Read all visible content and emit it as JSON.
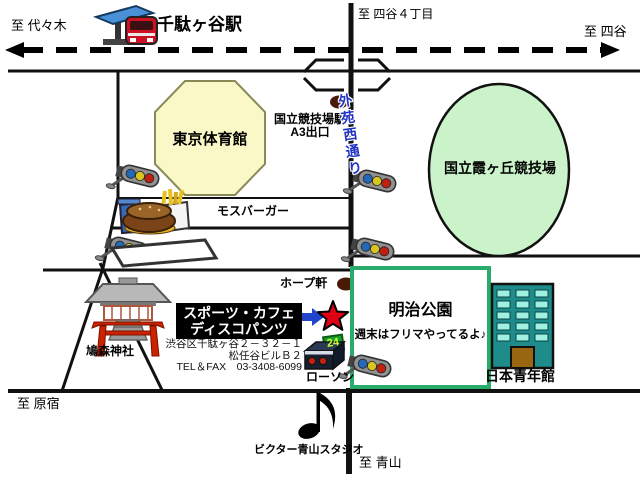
{
  "labels": {
    "to_yoyogi": "至 代々木",
    "sendagaya_station": "千駄ヶ谷駅",
    "to_yotsuya_4chome": "至 四谷４丁目",
    "to_yotsuya": "至 四谷",
    "tokyo_gymnasium": "東京体育館",
    "station_exit_line1": "国立競技場駅",
    "station_exit_line2": "A3出口",
    "gaien_nishi_dori": "外苑西通り",
    "kasumigaoka_stadium": "国立霞ヶ丘競技場",
    "mos_burger": "モスバーガー",
    "hope_ken": "ホープ軒",
    "meiji_park": "明治公園",
    "meiji_park_note": "週末はフリマやってるよ♪",
    "hatonomori_shrine": "鳩森神社",
    "nippon_seinenkan": "日本青年館",
    "lawson": "ローソン",
    "lawson_sign": "24",
    "victor_aoyama_studio": "ビクター青山スタジオ",
    "to_harajuku": "至 原宿",
    "to_aoyama": "至 青山"
  },
  "venue": {
    "name_line1": "スポーツ・カフェ",
    "name_line2": "ディスコパンツ",
    "address_line1": "渋谷区千駄ヶ谷２－３２－１",
    "address_line2": "松任谷ビルＢ２",
    "tel_line": "TEL＆FAX　03-3408-6099"
  },
  "icons": {
    "station": "train-station-icon",
    "traffic_light": "traffic-light-icon",
    "mos": "burger-meal-icon",
    "shrine": "torii-shrine-icon",
    "lawson": "convenience-store-icon",
    "building": "office-building-icon",
    "note": "music-note-icon",
    "star": "star-marker-icon",
    "arrow": "blue-arrow-icon"
  },
  "colors": {
    "road": "#111111",
    "gymnasium_fill": "#faf8c6",
    "stadium_fill": "#cbf3ca",
    "park_border": "#29ac6b",
    "train_red": "#cc1122",
    "canopy_blue": "#4a90d8",
    "star_red": "#e00012",
    "arrow_blue": "#2244cc",
    "gaien_text_blue": "#2233c4",
    "building_teal": "#1f8c8c",
    "lawson_sign_green": "#18a02a",
    "exit_dot": "#4a1a08"
  }
}
